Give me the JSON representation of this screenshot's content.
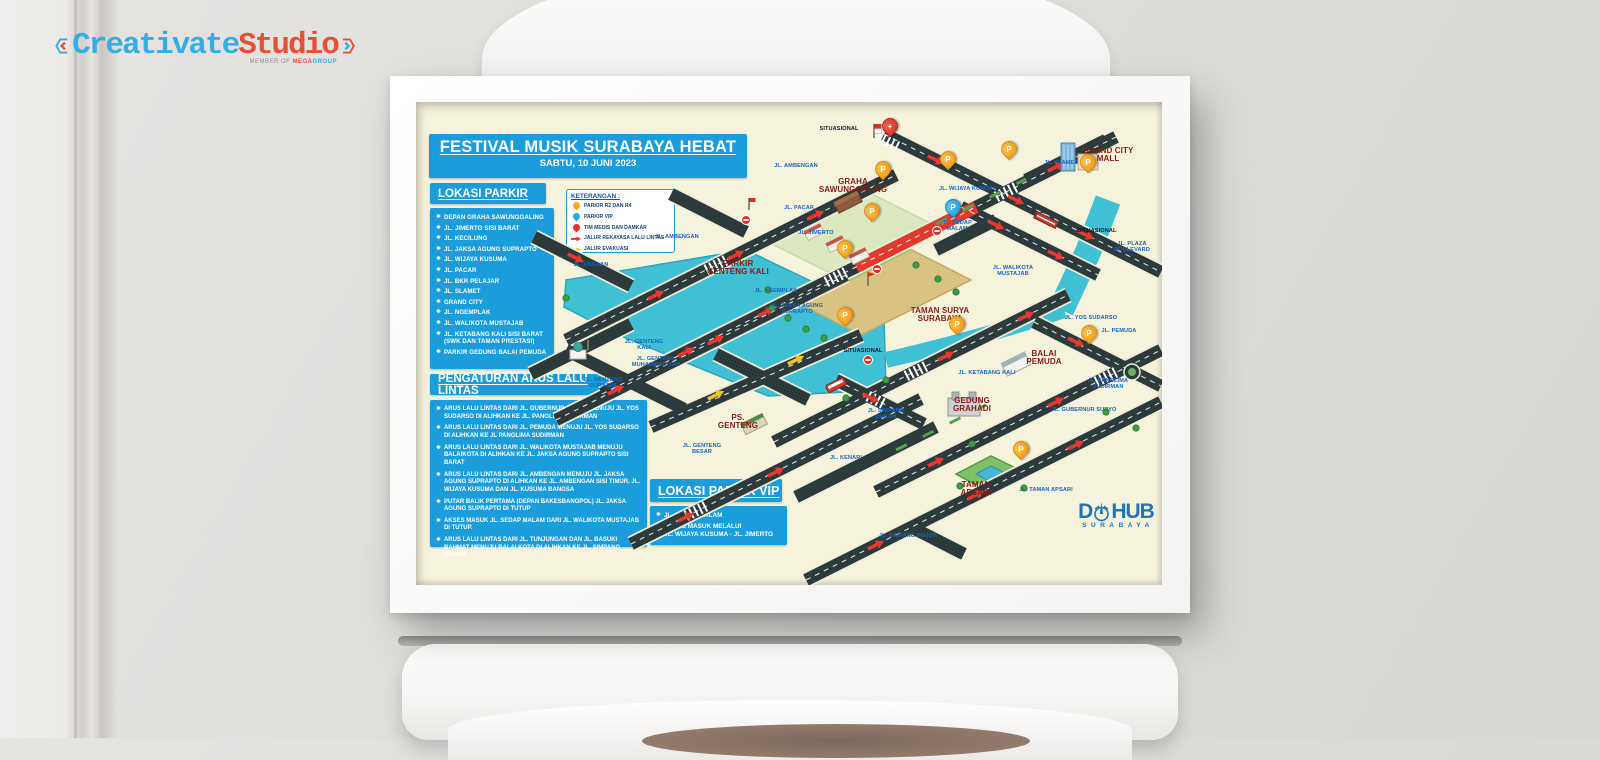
{
  "colors": {
    "blue": "#1b9ddc",
    "cream": "#f6f3dd",
    "road": "#2c3a3c",
    "river": "#3fc0d5",
    "red": "#e8392e",
    "orange": "#f6a71f",
    "place": "#8a1a10",
    "roadlabel": "#1565c0"
  },
  "studio_logo": {
    "brand_left": "Creativate",
    "brand_right": "Studio",
    "member_of": "MEMBER OF",
    "group1": "MEGA",
    "group2": "GROUP"
  },
  "poster": {
    "title": "FESTIVAL MUSIK SURABAYA HEBAT",
    "date": "SABTU, 10 JUNI 2023",
    "parking": {
      "header": "LOKASI PARKIR",
      "items": [
        "DEPAN GRAHA SAWUNGGALING",
        "JL. JIMERTO SISI BARAT",
        "JL. KECILUNG",
        "JL. JAKSA AGUNG SUPRAPTO",
        "JL. WIJAYA KUSUMA",
        "JL. PACAR",
        "JL. BKR PELAJAR",
        "JL. SLAMET",
        "GRAND CITY",
        "JL. NGEMPLAK",
        "JL. WALIKOTA MUSTAJAB",
        "JL. KETABANG KALI SISI BARAT (SWK DAN TAMAN PRESTASI)",
        "PARKIR GEDUNG BALAI PEMUDA"
      ]
    },
    "legend": {
      "header": "KETERANGAN :",
      "items": [
        {
          "icon": "pin-orange",
          "label": "PARKIR R2 DAN R4"
        },
        {
          "icon": "pin-blue",
          "label": "PARKIR VIP"
        },
        {
          "icon": "pin-red",
          "label": "TIM MEDIS DAN DAMKAR"
        },
        {
          "icon": "arr-red",
          "label": "JALUR REKAYASA LALU LINTAS"
        },
        {
          "icon": "arr-yellow",
          "label": "JALUR EVAKUASI"
        }
      ]
    },
    "traffic": {
      "header": "PENGATURAN ARUS LALU LINTAS",
      "items": [
        "ARUS LALU LINTAS DARI JL. GUBERNUR SURYO MENUJU JL. YOS SUDARSO DI ALIHKAN KE JL. PANGLIMA SUDIRMAN",
        "ARUS LALU LINTAS DARI JL. PEMUDA MENUJU JL. YOS SUDARSO DI ALIHKAN KE JL PANGLIMA SUDIRMAN",
        "ARUS LALU LINTAS DARI JL. WALIKOTA MUSTAJAB MENUJU BALAIKOTA DI ALIHKAN KE JL. JAKSA AGUNG SUPRAPTO SISI BARAT",
        "ARUS LALU LINTAS DARI JL. AMBENGAN MENUJU JL. JAKSA AGUNG SUPRAPTO DI ALIHKAN KE JL. AMBENGAN SISI TIMUR, JL. WIJAYA KUSUMA DAN JL. KUSUMA BANGSA",
        "PUTAR BALIK PERTAMA (DEPAN BAKESBANGPOL) JL. JAKSA AGUNG SUPRAPTO DI TUTUP",
        "AKSES MASUK JL. SEDAP MALAM DARI JL. WALIKOTA MUSTAJAB DI TUTUP.",
        "ARUS LALU LINTAS DARI JL. TUNJUNGAN DAN JL. BASUKI RAHMAT MENUJU BALAI KOTA DI ALIHKAN KE JL. SIMPANG DUKUH"
      ]
    },
    "vip": {
      "header": "LOKASI PARKIR VIP",
      "items": [
        "JL. SEDAP MALAM",
        "AKSES MASUK MELALUI\nJL. WIJAYA KUSUMA - JL. JIMERTO"
      ]
    },
    "dishub": {
      "part1": "D",
      "part2": "HUB",
      "sub": "SURABAYA"
    },
    "map": {
      "labels": [
        {
          "t": "SITUASIONAL",
          "x": 423,
          "y": 27,
          "c": "note"
        },
        {
          "t": "JL. AMBENGAN",
          "x": 380,
          "y": 64,
          "c": "road"
        },
        {
          "t": "GRAHA\nSAWUNGGALING",
          "x": 437,
          "y": 84,
          "c": "place"
        },
        {
          "t": "JL. SLAMET",
          "x": 645,
          "y": 61,
          "c": "road"
        },
        {
          "t": "GRAND CITY\nMALL",
          "x": 692,
          "y": 53,
          "c": "place"
        },
        {
          "t": "JL. WIJAYA KUSUMA",
          "x": 552,
          "y": 87,
          "c": "road"
        },
        {
          "t": "JL. PACAR",
          "x": 383,
          "y": 106,
          "c": "road"
        },
        {
          "t": "SITUASIONAL",
          "x": 681,
          "y": 129,
          "c": "note"
        },
        {
          "t": "JL. JIMERTO",
          "x": 400,
          "y": 131,
          "c": "road"
        },
        {
          "t": "JL. SEDAP\nMALAM",
          "x": 541,
          "y": 124,
          "c": "road"
        },
        {
          "t": "JL. PLAZA\nBOULEVARD",
          "x": 716,
          "y": 145,
          "c": "road"
        },
        {
          "t": "JL. AMBENGAN",
          "x": 261,
          "y": 135,
          "c": "road"
        },
        {
          "t": "JL. UNDAAN",
          "x": 175,
          "y": 163,
          "c": "road"
        },
        {
          "t": "PARKIR\nGENTENG KALI",
          "x": 322,
          "y": 166,
          "c": "place"
        },
        {
          "t": "JL. NGEMPLAK",
          "x": 360,
          "y": 189,
          "c": "road"
        },
        {
          "t": "JL. WALIKOTA\nMUSTAJAB",
          "x": 597,
          "y": 169,
          "c": "road"
        },
        {
          "t": "JL. JAKSA AGUNG\nSUPRAPTO",
          "x": 381,
          "y": 207,
          "c": "road"
        },
        {
          "t": "TAMAN SURYA\nSURABAYA",
          "x": 524,
          "y": 213,
          "c": "place"
        },
        {
          "t": "JL. YOS SUDARSO",
          "x": 675,
          "y": 216,
          "c": "road"
        },
        {
          "t": "JL. PEMUDA",
          "x": 703,
          "y": 229,
          "c": "road"
        },
        {
          "t": "SITUASIONAL",
          "x": 447,
          "y": 249,
          "c": "note"
        },
        {
          "t": "BALAI\nPEMUDA",
          "x": 628,
          "y": 256,
          "c": "place"
        },
        {
          "t": "JL. GENTENG\nKALI",
          "x": 228,
          "y": 243,
          "c": "road"
        },
        {
          "t": "JL. GENTENG\nMUHAMMADIYAH",
          "x": 240,
          "y": 260,
          "c": "road"
        },
        {
          "t": "JL. KETABANG KALI",
          "x": 571,
          "y": 271,
          "c": "road"
        },
        {
          "t": "JL. GENTENG\nDURASIM",
          "x": 187,
          "y": 281,
          "c": "road"
        },
        {
          "t": "JL. PANGLIMA SUDIRMAN",
          "x": 692,
          "y": 282,
          "c": "road"
        },
        {
          "t": "GEDUNG\nGRAHADI",
          "x": 556,
          "y": 303,
          "c": "place"
        },
        {
          "t": "JL. GUBERNUR SURYO",
          "x": 668,
          "y": 308,
          "c": "road"
        },
        {
          "t": "JL. SIMPANG\nDUKUH",
          "x": 470,
          "y": 312,
          "c": "road"
        },
        {
          "t": "PS.\nGENTENG",
          "x": 322,
          "y": 320,
          "c": "place"
        },
        {
          "t": "JL. GENTENG\nBESAR",
          "x": 286,
          "y": 347,
          "c": "road"
        },
        {
          "t": "JL. KENARI",
          "x": 430,
          "y": 356,
          "c": "road"
        },
        {
          "t": "TAMAN\nAPSARI",
          "x": 560,
          "y": 387,
          "c": "place"
        },
        {
          "t": "JL. TAMAN APSARI",
          "x": 630,
          "y": 388,
          "c": "road"
        },
        {
          "t": "JL. SIMPANG POJOK",
          "x": 492,
          "y": 434,
          "c": "road"
        }
      ],
      "pins": [
        {
          "x": 466,
          "y": 76,
          "k": "orange",
          "letter": "P"
        },
        {
          "x": 455,
          "y": 118,
          "k": "orange",
          "letter": "P"
        },
        {
          "x": 428,
          "y": 155,
          "k": "orange",
          "letter": "P"
        },
        {
          "x": 531,
          "y": 66,
          "k": "orange",
          "letter": "P"
        },
        {
          "x": 592,
          "y": 56,
          "k": "orange",
          "letter": "P"
        },
        {
          "x": 671,
          "y": 69,
          "k": "orange",
          "letter": "P"
        },
        {
          "x": 428,
          "y": 222,
          "k": "orange",
          "letter": "P"
        },
        {
          "x": 540,
          "y": 231,
          "k": "orange",
          "letter": "P"
        },
        {
          "x": 672,
          "y": 240,
          "k": "orange",
          "letter": "P"
        },
        {
          "x": 604,
          "y": 356,
          "k": "orange",
          "letter": "P"
        },
        {
          "x": 536,
          "y": 114,
          "k": "blue",
          "letter": "P"
        },
        {
          "x": 473,
          "y": 33,
          "k": "red",
          "letter": "+"
        }
      ]
    }
  }
}
